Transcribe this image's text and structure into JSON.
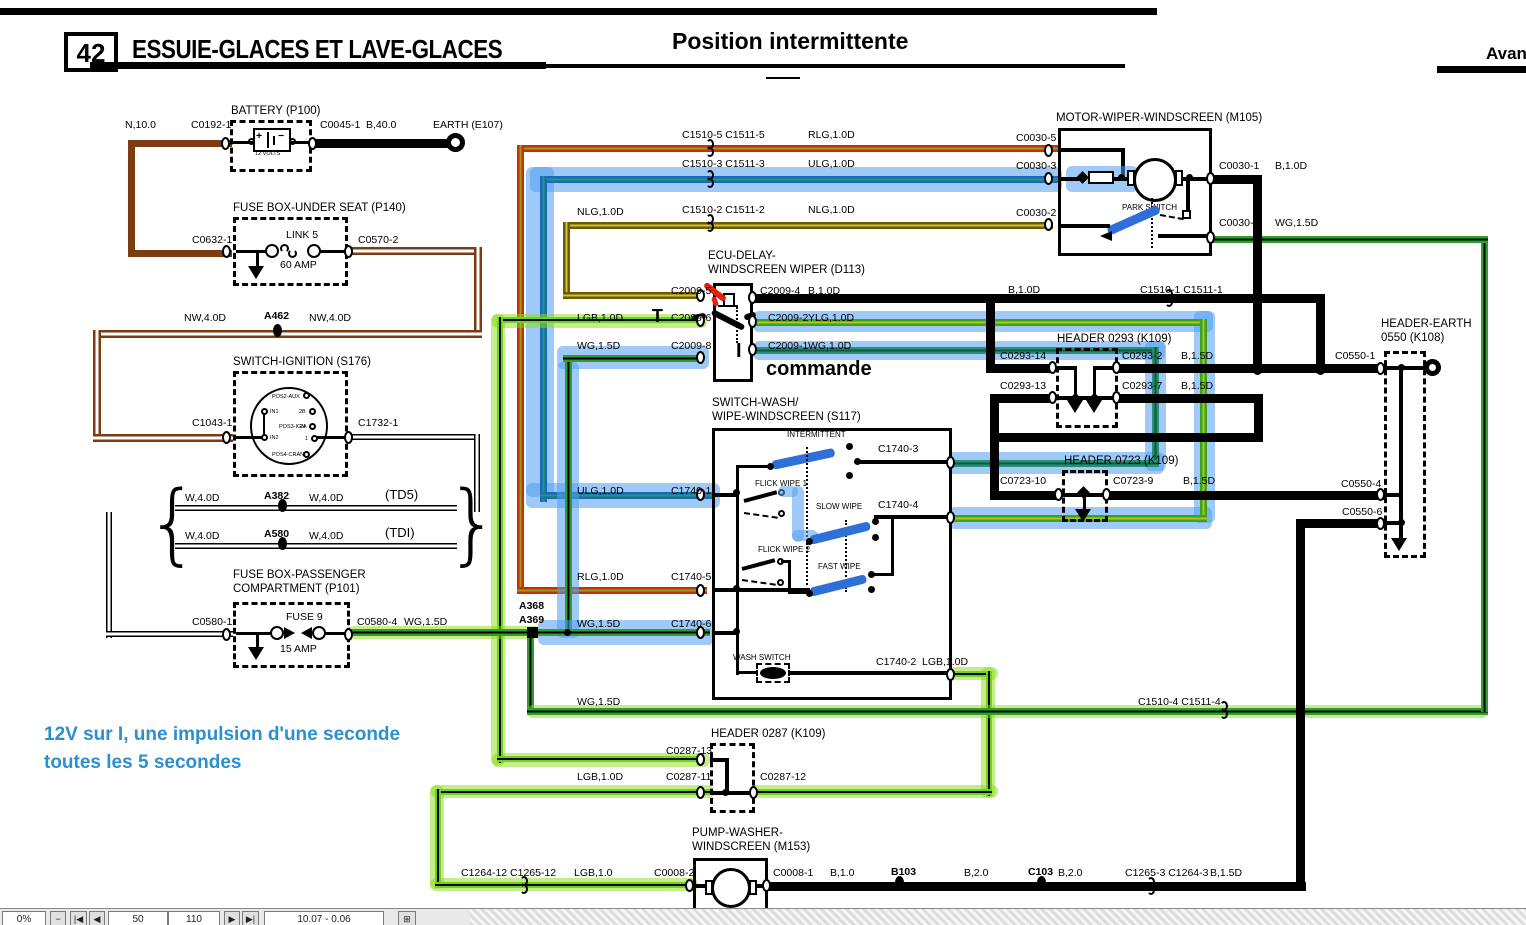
{
  "header": {
    "page_number": "42",
    "title": "ESSUIE-GLACES ET LAVE-GLACES",
    "subtitle": "Position intermittente",
    "corner": "Avant"
  },
  "note": {
    "line1": "12V sur I, une impulsion d'une seconde",
    "line2": "toutes les 5 secondes"
  },
  "annotations": {
    "t": "T",
    "i": "I",
    "commande": "commande"
  },
  "components": {
    "battery": {
      "title": "BATTERY (P100)",
      "volts": "12 VOLTS",
      "plus": "+",
      "minus": "−"
    },
    "fuse_underseat": {
      "title": "FUSE BOX-UNDER SEAT (P140)",
      "link": "LINK 5",
      "amp": "60 AMP"
    },
    "ignition": {
      "title": "SWITCH-IGNITION (S176)",
      "pins": {
        "pos2": "POS2-AUX",
        "in1": "IN1",
        "b2": "2B",
        "pos3": "POS3-IGN",
        "a2": "2A",
        "in2": "IN2",
        "one": "1",
        "pos4": "POS4-CRANK"
      }
    },
    "fuse_passenger": {
      "title": "FUSE BOX-PASSENGER\nCOMPARTMENT (P101)",
      "fuse": "FUSE 9",
      "amp": "15 AMP"
    },
    "ecu": {
      "title": "ECU-DELAY-\nWINDSCREEN WIPER (D113)"
    },
    "s117": {
      "title": "SWITCH-WASH/\nWIPE-WINDSCREEN (S117)",
      "modes": {
        "intermittent": "INTERMITTENT",
        "flick1": "FLICK WIPE 1",
        "slow": "SLOW WIPE",
        "flick2": "FLICK WIPE 2",
        "fast": "FAST WIPE",
        "wash": "WASH SWITCH"
      }
    },
    "motor": {
      "title": "MOTOR-WIPER-WINDSCREEN (M105)",
      "park": "PARK SWITCH"
    },
    "h0293": {
      "title": "HEADER 0293 (K109)"
    },
    "h0723": {
      "title": "HEADER 0723 (K109)"
    },
    "k108": {
      "title": "HEADER-EARTH\n0550 (K108)"
    },
    "h0287": {
      "title": "HEADER 0287 (K109)"
    },
    "pump": {
      "title": "PUMP-WASHER-\nWINDSCREEN (M153)"
    }
  },
  "labels": [
    {
      "n": "n100",
      "t": "N,10.0",
      "x": 125,
      "y": 119
    },
    {
      "n": "c0192-1",
      "t": "C0192-1",
      "x": 191,
      "y": 119
    },
    {
      "n": "c0045-1",
      "t": "C0045-1",
      "x": 320,
      "y": 119
    },
    {
      "n": "b400",
      "t": "B,40.0",
      "x": 366,
      "y": 119
    },
    {
      "n": "earth-e107",
      "t": "EARTH (E107)",
      "x": 433,
      "y": 119
    },
    {
      "n": "c0632-1",
      "t": "C0632-1",
      "x": 192,
      "y": 234
    },
    {
      "n": "c0570-2",
      "t": "C0570-2",
      "x": 358,
      "y": 234
    },
    {
      "n": "nw40d-a",
      "t": "NW,4.0D",
      "x": 184,
      "y": 312
    },
    {
      "n": "a462",
      "t": "A462",
      "x": 264,
      "y": 310,
      "c": "b"
    },
    {
      "n": "nw40d-b",
      "t": "NW,4.0D",
      "x": 309,
      "y": 312
    },
    {
      "n": "c1043-1",
      "t": "C1043-1",
      "x": 192,
      "y": 417
    },
    {
      "n": "c1732-1",
      "t": "C1732-1",
      "x": 358,
      "y": 417
    },
    {
      "n": "w40d-a",
      "t": "W,4.0D",
      "x": 185,
      "y": 492
    },
    {
      "n": "a382",
      "t": "A382",
      "x": 264,
      "y": 490,
      "c": "b"
    },
    {
      "n": "w40d-b",
      "t": "W,4.0D",
      "x": 309,
      "y": 492
    },
    {
      "n": "td5",
      "t": "(TD5)",
      "x": 385,
      "y": 487,
      "c": "big"
    },
    {
      "n": "w40d-c",
      "t": "W,4.0D",
      "x": 185,
      "y": 530
    },
    {
      "n": "a580",
      "t": "A580",
      "x": 264,
      "y": 528,
      "c": "b"
    },
    {
      "n": "w40d-d",
      "t": "W,4.0D",
      "x": 309,
      "y": 530
    },
    {
      "n": "tdi",
      "t": "(TDI)",
      "x": 385,
      "y": 525,
      "c": "big"
    },
    {
      "n": "c0580-1",
      "t": "C0580-1",
      "x": 192,
      "y": 616
    },
    {
      "n": "c0580-4",
      "t": "C0580-4",
      "x": 357,
      "y": 616
    },
    {
      "n": "wg15d-fuse",
      "t": "WG,1.5D",
      "x": 404,
      "y": 616
    },
    {
      "n": "c1510-5",
      "t": "C1510-5 C1511-5",
      "x": 682,
      "y": 129
    },
    {
      "n": "rlg-top",
      "t": "RLG,1.0D",
      "x": 808,
      "y": 129
    },
    {
      "n": "c1510-3",
      "t": "C1510-3 C1511-3",
      "x": 682,
      "y": 158
    },
    {
      "n": "ulg-top",
      "t": "ULG,1.0D",
      "x": 808,
      "y": 158
    },
    {
      "n": "nlg-l",
      "t": "NLG,1.0D",
      "x": 577,
      "y": 206
    },
    {
      "n": "c1510-2",
      "t": "C1510-2 C1511-2",
      "x": 682,
      "y": 204
    },
    {
      "n": "nlg-r",
      "t": "NLG,1.0D",
      "x": 808,
      "y": 204
    },
    {
      "n": "c2009-5",
      "t": "C2009-5",
      "x": 671,
      "y": 285
    },
    {
      "n": "c2009-4",
      "t": "C2009-4",
      "x": 760,
      "y": 285
    },
    {
      "n": "b10d-ecu",
      "t": "B,1.0D",
      "x": 808,
      "y": 285
    },
    {
      "n": "lgb-ecu",
      "t": "LGB,1.0D",
      "x": 577,
      "y": 312
    },
    {
      "n": "c2009-6",
      "t": "C2009-6",
      "x": 671,
      "y": 312
    },
    {
      "n": "c2009-2",
      "t": "C2009-2",
      "x": 768,
      "y": 312
    },
    {
      "n": "ylg-ecu",
      "t": "YLG,1.0D",
      "x": 808,
      "y": 312
    },
    {
      "n": "wg15d-ecu",
      "t": "WG,1.5D",
      "x": 577,
      "y": 340
    },
    {
      "n": "c2009-8",
      "t": "C2009-8",
      "x": 671,
      "y": 340
    },
    {
      "n": "c2009-1",
      "t": "C2009-1",
      "x": 768,
      "y": 340
    },
    {
      "n": "wg10d-ecu",
      "t": "WG,1.0D",
      "x": 808,
      "y": 340
    },
    {
      "n": "b10d-mid",
      "t": "B,1.0D",
      "x": 1008,
      "y": 284
    },
    {
      "n": "c1510-1",
      "t": "C1510-1 C1511-1",
      "x": 1140,
      "y": 284
    },
    {
      "n": "c0293-14",
      "t": "C0293-14",
      "x": 1000,
      "y": 350
    },
    {
      "n": "c0293-2",
      "t": "C0293-2",
      "x": 1122,
      "y": 350
    },
    {
      "n": "b15d-a",
      "t": "B,1.5D",
      "x": 1181,
      "y": 350
    },
    {
      "n": "c0293-13",
      "t": "C0293-13",
      "x": 1000,
      "y": 380
    },
    {
      "n": "c0293-7",
      "t": "C0293-7",
      "x": 1122,
      "y": 380
    },
    {
      "n": "b15d-b",
      "t": "B,1.5D",
      "x": 1181,
      "y": 380
    },
    {
      "n": "c0030-5",
      "t": "C0030-5",
      "x": 1016,
      "y": 132
    },
    {
      "n": "c0030-3",
      "t": "C0030-3",
      "x": 1016,
      "y": 160
    },
    {
      "n": "c0030-2",
      "t": "C0030-2",
      "x": 1016,
      "y": 207
    },
    {
      "n": "c0030-1",
      "t": "C0030-1",
      "x": 1219,
      "y": 160
    },
    {
      "n": "b10d-mot",
      "t": "B,1.0D",
      "x": 1275,
      "y": 160
    },
    {
      "n": "c0030-4",
      "t": "C0030-4",
      "x": 1219,
      "y": 217
    },
    {
      "n": "wg15d-mot",
      "t": "WG,1.5D",
      "x": 1275,
      "y": 217
    },
    {
      "n": "c0550-1",
      "t": "C0550-1",
      "x": 1335,
      "y": 350
    },
    {
      "n": "c0550-4",
      "t": "C0550-4",
      "x": 1341,
      "y": 478
    },
    {
      "n": "c0550-6",
      "t": "C0550-6",
      "x": 1342,
      "y": 506
    },
    {
      "n": "c0723-10",
      "t": "C0723-10",
      "x": 1000,
      "y": 475
    },
    {
      "n": "c0723-9",
      "t": "C0723-9",
      "x": 1113,
      "y": 475
    },
    {
      "n": "b15d-c",
      "t": "B,1.5D",
      "x": 1183,
      "y": 475
    },
    {
      "n": "c1740-3",
      "t": "C1740-3",
      "x": 878,
      "y": 443
    },
    {
      "n": "ulg-sw",
      "t": "ULG,1.0D",
      "x": 577,
      "y": 485
    },
    {
      "n": "c1740-1",
      "t": "C1740-1",
      "x": 671,
      "y": 485
    },
    {
      "n": "c1740-4",
      "t": "C1740-4",
      "x": 878,
      "y": 499
    },
    {
      "n": "rlg-sw",
      "t": "RLG,1.0D",
      "x": 577,
      "y": 571
    },
    {
      "n": "c1740-5",
      "t": "C1740-5",
      "x": 671,
      "y": 571
    },
    {
      "n": "a368",
      "t": "A368",
      "x": 519,
      "y": 600,
      "c": "b"
    },
    {
      "n": "a369",
      "t": "A369",
      "x": 519,
      "y": 614,
      "c": "b"
    },
    {
      "n": "wg15d-sw",
      "t": "WG,1.5D",
      "x": 577,
      "y": 618
    },
    {
      "n": "c1740-6",
      "t": "C1740-6",
      "x": 671,
      "y": 618
    },
    {
      "n": "c1740-2",
      "t": "C1740-2",
      "x": 876,
      "y": 656
    },
    {
      "n": "lgb-sw",
      "t": "LGB,1.0D",
      "x": 922,
      "y": 656
    },
    {
      "n": "wg15d-low",
      "t": "WG,1.5D",
      "x": 577,
      "y": 696
    },
    {
      "n": "c1510-4",
      "t": "C1510-4 C1511-4",
      "x": 1138,
      "y": 696
    },
    {
      "n": "c0287-13",
      "t": "C0287-13",
      "x": 666,
      "y": 745
    },
    {
      "n": "lgb-hdr",
      "t": "LGB,1.0D",
      "x": 577,
      "y": 771
    },
    {
      "n": "c0287-11",
      "t": "C0287-11",
      "x": 666,
      "y": 771
    },
    {
      "n": "c0287-12",
      "t": "C0287-12",
      "x": 760,
      "y": 771
    },
    {
      "n": "c1264-12",
      "t": "C1264-12 C1265-12",
      "x": 461,
      "y": 867
    },
    {
      "n": "lgb-pump",
      "t": "LGB,1.0",
      "x": 574,
      "y": 867
    },
    {
      "n": "c0008-2",
      "t": "C0008-2",
      "x": 654,
      "y": 867
    },
    {
      "n": "c0008-1",
      "t": "C0008-1",
      "x": 773,
      "y": 867
    },
    {
      "n": "b10-pump",
      "t": "B,1.0",
      "x": 830,
      "y": 867
    },
    {
      "n": "b103",
      "t": "B103",
      "x": 891,
      "y": 866,
      "c": "b"
    },
    {
      "n": "b20-a",
      "t": "B,2.0",
      "x": 964,
      "y": 867
    },
    {
      "n": "c103",
      "t": "C103",
      "x": 1028,
      "y": 866,
      "c": "b"
    },
    {
      "n": "b20-b",
      "t": "B,2.0",
      "x": 1058,
      "y": 867
    },
    {
      "n": "c1265-3",
      "t": "C1265-3 C1264-3",
      "x": 1125,
      "y": 867
    },
    {
      "n": "b15d-d",
      "t": "B,1.5D",
      "x": 1210,
      "y": 867
    }
  ],
  "statusbar": {
    "zoom": "0%",
    "minus": "−",
    "nav_first": "|◀",
    "nav_prev": "◀",
    "range_start": "50",
    "range_end": "110",
    "nav_next": "▶",
    "nav_last": "▶|",
    "coords": "10.07 - 0.06",
    "grid": "⊞"
  }
}
